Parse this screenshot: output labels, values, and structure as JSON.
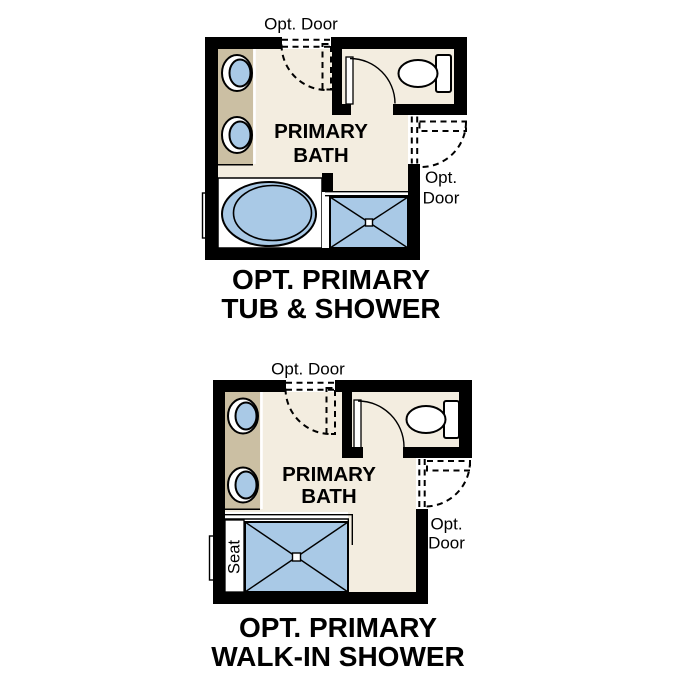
{
  "colors": {
    "background": "#ffffff",
    "wall": "#000000",
    "floor": "#f3ede0",
    "vanity": "#cbbfa3",
    "fixture_blue": "#a9c9e6",
    "fixture_white": "#ffffff",
    "text": "#000000"
  },
  "plans": [
    {
      "id": "tub-and-shower",
      "top_door_label": "Opt. Door",
      "room_label_line1": "PRIMARY",
      "room_label_line2": "BATH",
      "side_door_label_line1": "Opt.",
      "side_door_label_line2": "Door",
      "title_line1": "OPT. PRIMARY",
      "title_line2": "TUB & SHOWER",
      "fixtures": [
        "vanity-with-two-sinks",
        "bathtub",
        "shower-pan",
        "toilet",
        "window",
        "swing-door"
      ]
    },
    {
      "id": "walk-in-shower",
      "top_door_label": "Opt. Door",
      "room_label_line1": "PRIMARY",
      "room_label_line2": "BATH",
      "side_door_label_line1": "Opt.",
      "side_door_label_line2": "Door",
      "seat_label": "Seat",
      "title_line1": "OPT. PRIMARY",
      "title_line2": "WALK-IN SHOWER",
      "fixtures": [
        "vanity-with-two-sinks",
        "walk-in-shower-pan",
        "shower-seat",
        "toilet",
        "window",
        "swing-door"
      ]
    }
  ]
}
